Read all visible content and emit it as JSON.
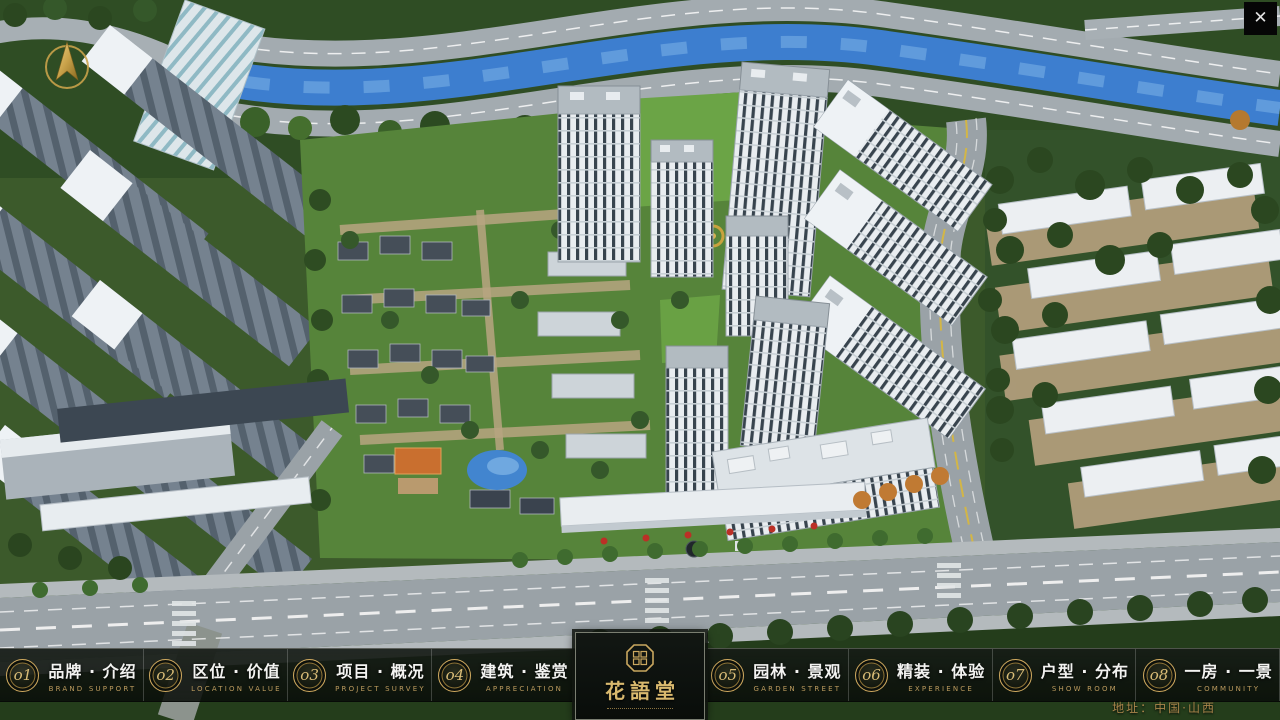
{
  "window": {
    "close_glyph": "✕"
  },
  "logo": {
    "title": "花語堂"
  },
  "address": {
    "text": "地址：中国·山西"
  },
  "menu": {
    "items": [
      {
        "num": "o1",
        "label": "品牌 · 介绍",
        "sub": "BRAND SUPPORT"
      },
      {
        "num": "o2",
        "label": "区位 · 价值",
        "sub": "LOCATION VALUE"
      },
      {
        "num": "o3",
        "label": "项目 · 概况",
        "sub": "PROJECT SURVEY"
      },
      {
        "num": "o4",
        "label": "建筑 · 鉴赏",
        "sub": "APPRECIATION"
      },
      {
        "num": "o5",
        "label": "园林 · 景观",
        "sub": "GARDEN STREET"
      },
      {
        "num": "o6",
        "label": "精装 · 体验",
        "sub": "EXPERIENCE"
      },
      {
        "num": "o7",
        "label": "户型 · 分布",
        "sub": "SHOW ROOM"
      },
      {
        "num": "o8",
        "label": "一房 · 一景",
        "sub": "COMMUNITY"
      }
    ]
  },
  "colors": {
    "accent_gold": "#c9a75f",
    "subtitle_gold": "#bb9a5e",
    "address_gold": "#a9854b",
    "bar_background": "#10150f",
    "river_blue": "#3d7ecf"
  }
}
